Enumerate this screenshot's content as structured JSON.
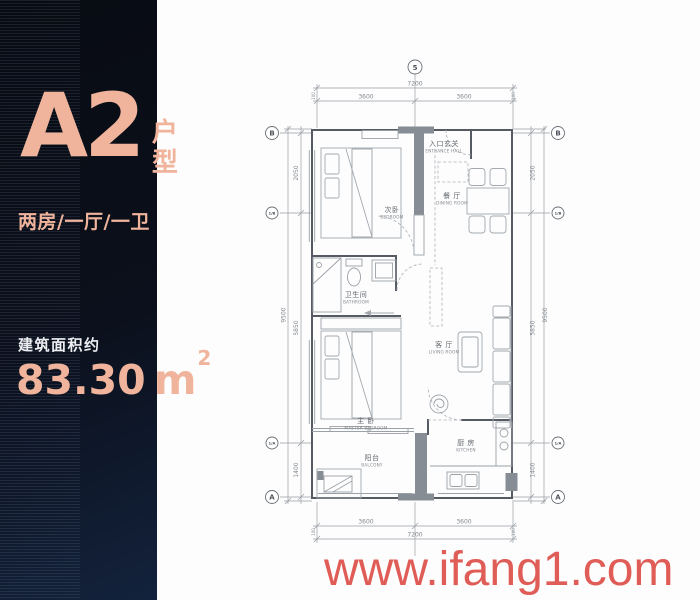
{
  "colors": {
    "accent": "#f0b49c",
    "text_light": "#eceef2",
    "watermark": "#dd4f4a",
    "panel_bg": "#080b12"
  },
  "panel": {
    "unit_name": "A2",
    "unit_suffix": "户型",
    "unit_config": "两房/一厅/一卫",
    "area_label": "建筑面积约",
    "area_value": "83.30",
    "area_unit": "m",
    "area_exponent": "2"
  },
  "plan": {
    "grid": {
      "axis_top": "5",
      "axis_b": "B",
      "axis_1b": "1/B",
      "axis_1a": "1/A",
      "axis_a": "A"
    },
    "dims": {
      "top_total": "7200",
      "top_seg_left": "3600",
      "top_seg_right": "3600",
      "bottom_total": "7200",
      "bottom_seg_left": "3600",
      "bottom_seg_right": "3600",
      "side_total": "9500",
      "side_seg_top": "2050",
      "side_seg_mid": "5850",
      "side_seg_bottom": "1400",
      "end_offset": "100"
    },
    "rooms": {
      "entrance": {
        "zh": "入口玄关",
        "en": "ENTRANCE HALL"
      },
      "dining": {
        "zh": "餐 厅",
        "en": "DINING ROOM"
      },
      "bedroom": {
        "zh": "次卧",
        "en": "BEDROOM"
      },
      "bathroom": {
        "zh": "卫生间",
        "en": "BATHROOM"
      },
      "living": {
        "zh": "客 厅",
        "en": "LIVING ROOM"
      },
      "master": {
        "zh": "主 卧",
        "en": "MASTER BEDROOM"
      },
      "balcony": {
        "zh": "阳台",
        "en": "BALCONY"
      },
      "kitchen": {
        "zh": "厨 房",
        "en": "KITCHEN"
      }
    }
  },
  "watermark": {
    "text": "www.ifang1.com"
  }
}
